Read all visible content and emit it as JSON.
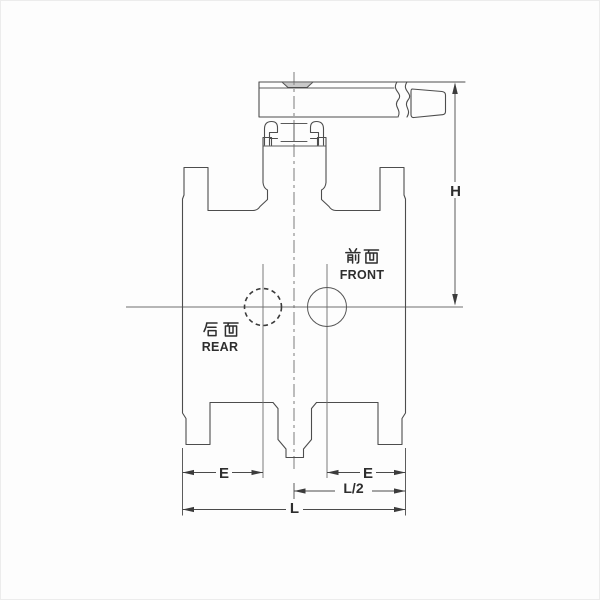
{
  "drawing": {
    "annotations": {
      "front": {
        "cjk": "前面",
        "latin": "FRONT"
      },
      "rear": {
        "cjk": "后面",
        "latin": "REAR"
      }
    },
    "dimensions": {
      "height": "H",
      "end_to_port_left": "E",
      "end_to_port_right": "E",
      "half_length": "L/2",
      "length": "L"
    },
    "colors": {
      "line": "#4d4d4d",
      "dimension": "#4a4a4a",
      "text": "#2e2e2e",
      "background": "#fdfdfd"
    }
  }
}
